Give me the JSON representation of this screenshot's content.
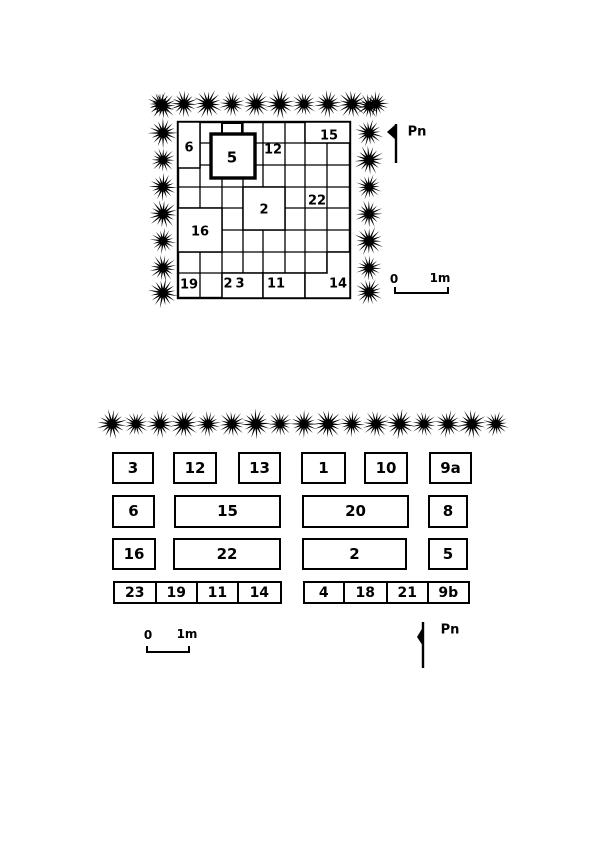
{
  "figure": {
    "background": "#ffffff",
    "ink": "#000000"
  },
  "upper_plan": {
    "cells": [
      {
        "label": "6"
      },
      {
        "label": "5"
      },
      {
        "label": "12"
      },
      {
        "label": "15"
      },
      {
        "label": "2"
      },
      {
        "label": "22"
      },
      {
        "label": "16"
      },
      {
        "label": "19"
      },
      {
        "label": "23"
      },
      {
        "label": "11"
      },
      {
        "label": "14"
      }
    ],
    "north_label": "Pn",
    "scale_bar": {
      "start": "0",
      "end": "1m"
    }
  },
  "lower_plan": {
    "rows": [
      {
        "boxes": [
          {
            "label": "3"
          },
          {
            "label": "12"
          },
          {
            "label": "13"
          },
          {
            "label": "1"
          },
          {
            "label": "10"
          },
          {
            "label": "9a"
          }
        ]
      },
      {
        "boxes": [
          {
            "label": "6"
          },
          {
            "label": "15"
          },
          {
            "label": "20"
          },
          {
            "label": "8"
          }
        ]
      },
      {
        "boxes": [
          {
            "label": "16"
          },
          {
            "label": "22"
          },
          {
            "label": "2"
          },
          {
            "label": "5"
          }
        ]
      },
      {
        "boxes": [
          {
            "label": "23"
          },
          {
            "label": "19"
          },
          {
            "label": "11"
          },
          {
            "label": "14"
          },
          {
            "label": "4"
          },
          {
            "label": "18"
          },
          {
            "label": "21"
          },
          {
            "label": "9b"
          }
        ]
      }
    ],
    "north_label": "Pn",
    "scale_bar": {
      "start": "0",
      "end": "1m"
    }
  }
}
